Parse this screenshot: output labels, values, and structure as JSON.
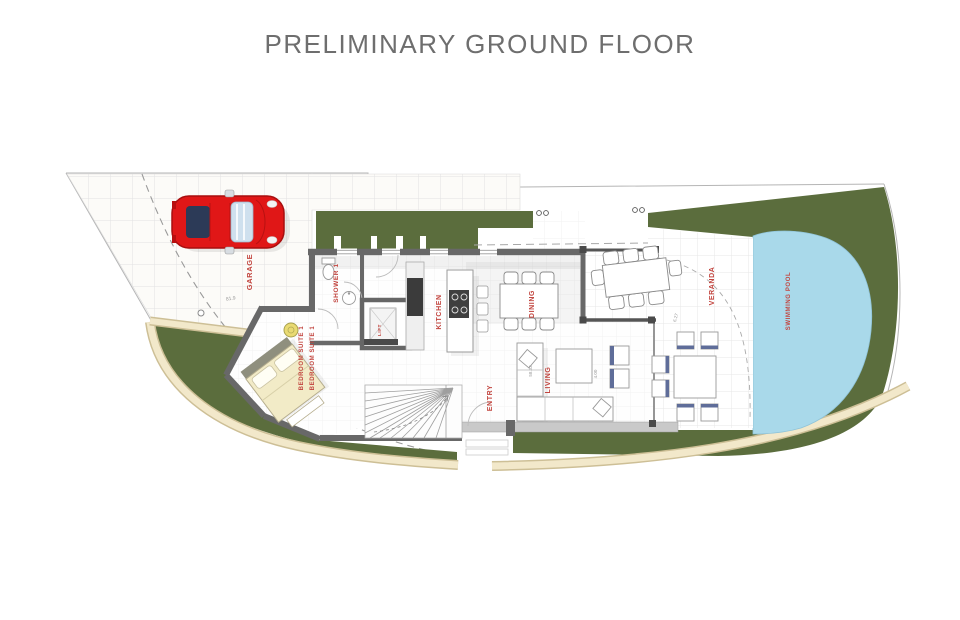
{
  "title": "PRELIMINARY GROUND FLOOR",
  "rooms": {
    "garage": "GARAGE",
    "shower": "SHOWER 1",
    "lift": "LIFT",
    "kitchen": "KITCHEN",
    "dining": "DINING",
    "veranda": "VERANDA",
    "swimming_pool": "SWIMMING POOL",
    "bedroom_suite_a": "BEDROOM SUITE 1",
    "bedroom_suite_b": "BEDROOM SUITE 1",
    "entry": "ENTRY",
    "living": "LIVING"
  },
  "dimensions": {
    "garage_level": "81.9",
    "veranda_radius": "6.27",
    "living_width": "4.00",
    "sofa_length": "58.32"
  },
  "colors": {
    "lawn_green": "#5b6d3d",
    "pool_blue": "#a9d9ea",
    "path_cream": "#f2e8ca",
    "path_tan": "#cdbf96",
    "label_red": "#c2453f",
    "car_red": "#e01717",
    "wall_gray": "#686868",
    "title_gray": "#6e6e6e"
  }
}
